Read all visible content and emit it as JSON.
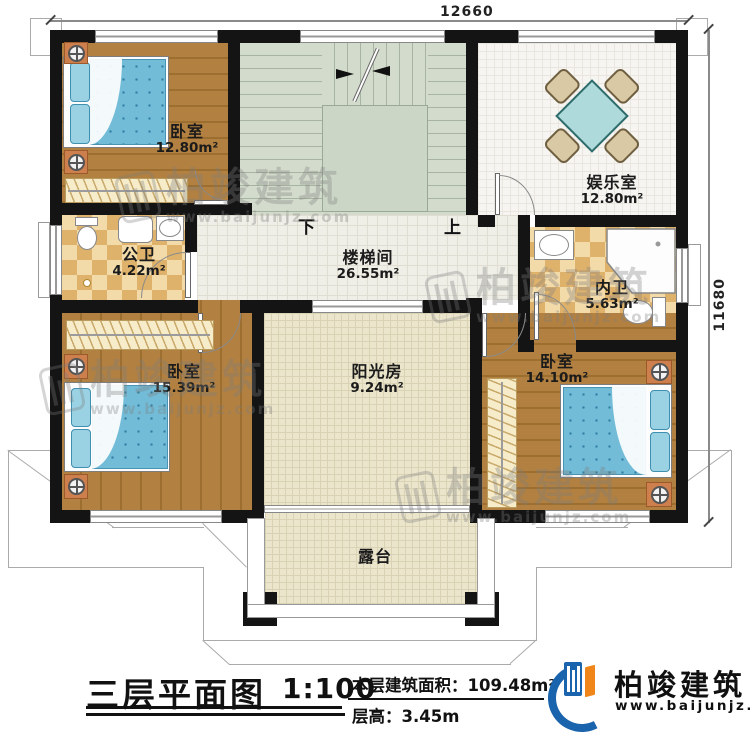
{
  "dimensions": {
    "width": "12660",
    "height": "11680"
  },
  "rooms": {
    "bedroom_tl": {
      "name": "卧室",
      "area": "12.80m²"
    },
    "bathroom_public": {
      "name": "公卫",
      "area": "4.22m²"
    },
    "stairwell": {
      "name": "楼梯间",
      "area": "26.55m²"
    },
    "entertainment": {
      "name": "娱乐室",
      "area": "12.80m²"
    },
    "bathroom_inner": {
      "name": "内卫",
      "area": "5.63m²"
    },
    "bedroom_bl": {
      "name": "卧室",
      "area": "15.39m²"
    },
    "bedroom_br": {
      "name": "卧室",
      "area": "14.10m²"
    },
    "sunroom": {
      "name": "阳光房",
      "area": "9.24m²"
    },
    "terrace": {
      "name": "露台"
    }
  },
  "stairs": {
    "down": "下",
    "up": "上"
  },
  "title": {
    "name": "三层平面图",
    "scale": "1:100",
    "area_label": "本层建筑面积：",
    "area_value": "109.48m²",
    "height_label": "层高：",
    "height_value": "3.45m"
  },
  "brand": {
    "name": "柏竣建筑",
    "url": "www.baijunjz.com"
  },
  "watermark": {
    "text": "柏竣建筑",
    "url": "www.baijunjz.com"
  },
  "colors": {
    "wall": "#141414",
    "wood": "#ad7c3c",
    "stair": "#d3dccc",
    "brand_blue": "#1a63ad",
    "brand_orange": "#f08519",
    "bed_blue": "#72bcd8"
  }
}
